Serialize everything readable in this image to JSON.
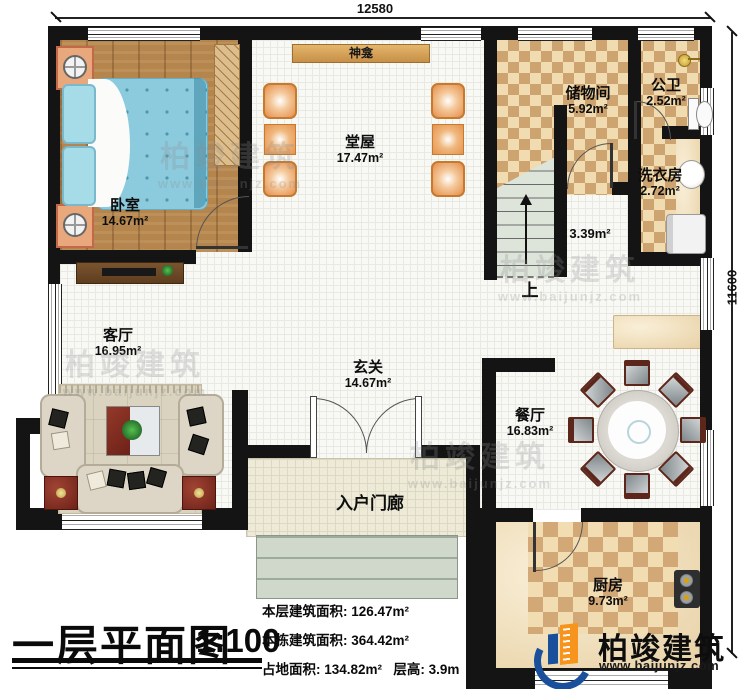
{
  "meta": {
    "plan_title": "一层平面图",
    "scale": "1:100"
  },
  "dimensions": {
    "top": "12580",
    "right": "11600"
  },
  "rooms": {
    "bedroom": {
      "label": "卧室",
      "area": "14.67m²"
    },
    "hall": {
      "label": "堂屋",
      "area": "17.47m²"
    },
    "storage": {
      "label": "储物间",
      "area": "5.92m²"
    },
    "bathroom": {
      "label": "公卫",
      "area": "2.52m²"
    },
    "laundry": {
      "label": "洗衣房",
      "area": "2.72m²"
    },
    "stairwell": {
      "area": "3.39m²",
      "direction": "上"
    },
    "living": {
      "label": "客厅",
      "area": "16.95m²"
    },
    "foyer": {
      "label": "玄关",
      "area": "14.67m²"
    },
    "dining": {
      "label": "餐厅",
      "area": "16.83m²"
    },
    "kitchen": {
      "label": "厨房",
      "area": "9.73m²"
    },
    "porch": {
      "label": "入户门廊"
    }
  },
  "fixtures": {
    "shrine": "神龛"
  },
  "stats": {
    "floor_area_label": "本层建筑面积:",
    "floor_area": "126.47m²",
    "building_area_label": "本栋建筑面积:",
    "building_area": "364.42m²",
    "footprint_label": "占地面积:",
    "footprint": "134.82m²",
    "height_label": "层高:",
    "height": "3.9m"
  },
  "branding": {
    "name": "柏竣建筑",
    "url": "www.baijunjz.com"
  },
  "colors": {
    "wall": "#141414",
    "wood_floor": "#b5854e",
    "checker_dark": "#cda470",
    "checker_light": "#f0dcb0",
    "brand_blue": "#1a4f9c",
    "brand_orange": "#f7941e"
  }
}
